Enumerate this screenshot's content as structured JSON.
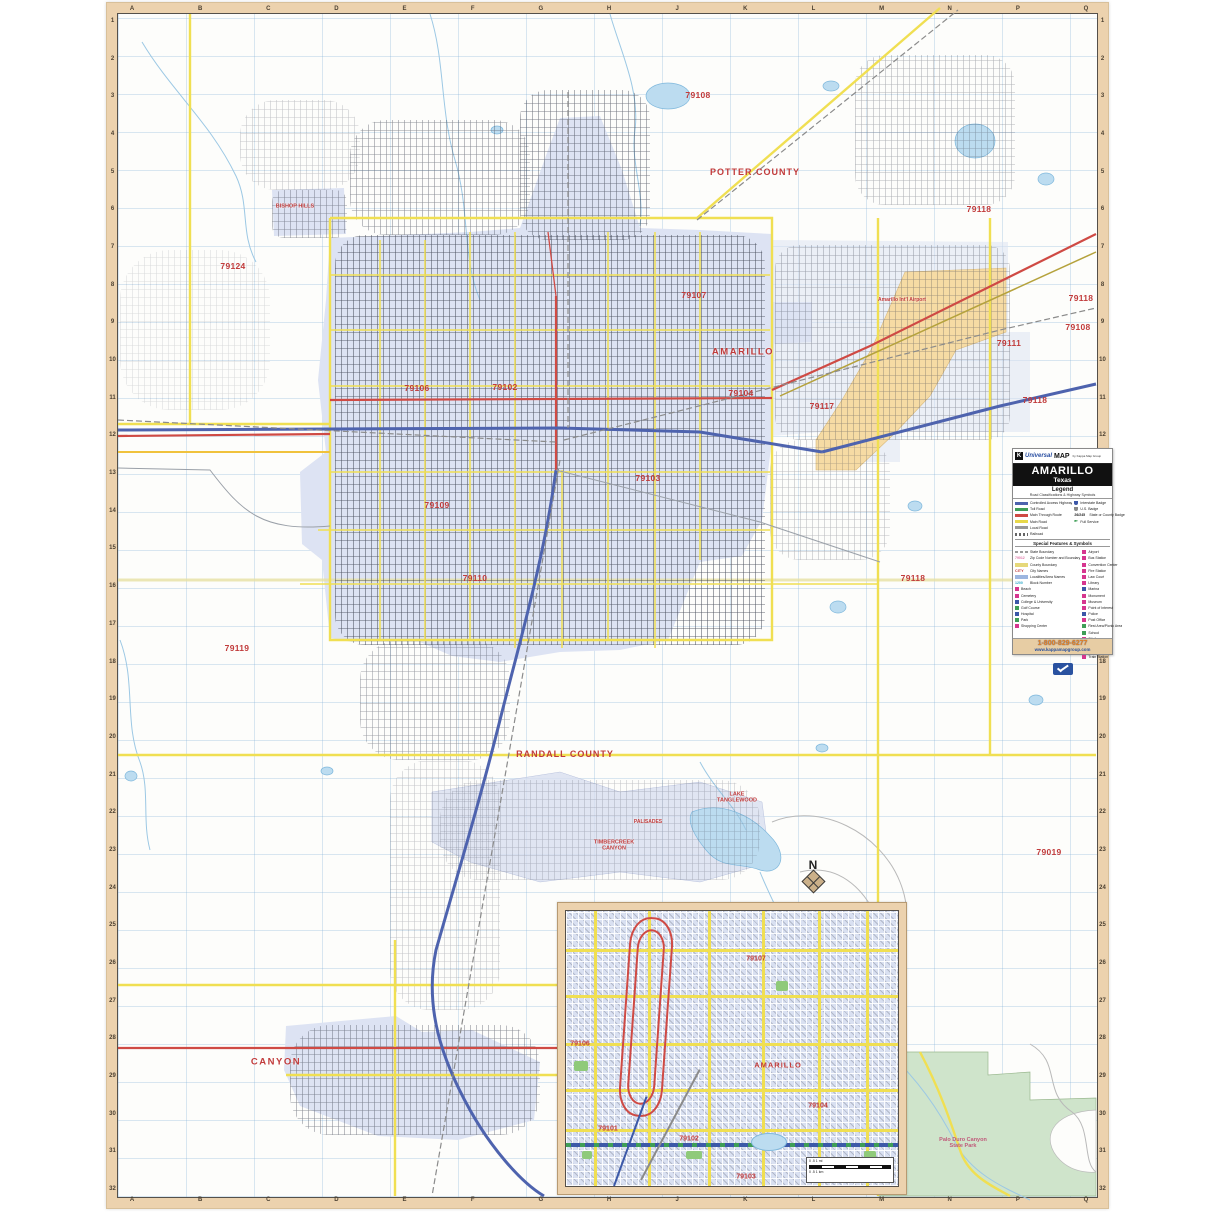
{
  "title_block": {
    "brand_k": "K",
    "brand_universal": "Universal",
    "brand_map": "MAP",
    "brand_by": "by Kappa Map Group",
    "title": "AMARILLO",
    "subtitle": "Texas",
    "legend_heading": "Legend",
    "legend_sub": "Road Classifications & Highway Symbols",
    "special_heading": "Special Features & Symbols",
    "footer": {
      "phone": "1-800-829-6277",
      "url": "www.kappamapgroup.com"
    }
  },
  "legend": {
    "road_classes": [
      {
        "label": "Controlled Access Highway",
        "kind": "line",
        "color": "#4e63ae"
      },
      {
        "label": "Toll Road",
        "kind": "line",
        "color": "#3f9e57"
      },
      {
        "label": "Main Through Route",
        "kind": "line",
        "color": "#cf4a44"
      },
      {
        "label": "Main Road",
        "kind": "line",
        "color": "#e8d84a"
      },
      {
        "label": "Local Road",
        "kind": "line",
        "color": "#999999"
      },
      {
        "label": "Railroad",
        "kind": "rail",
        "color": "#666666"
      }
    ],
    "badges": [
      {
        "label": "Interstate Badge",
        "kind": "shield",
        "color": "#3c57a8"
      },
      {
        "label": "U.S. Badge",
        "kind": "shield",
        "color": "#888888"
      },
      {
        "label": "State or County Badge",
        "kind": "text",
        "text": "26/245"
      },
      {
        "label": "Full Service",
        "kind": "flag",
        "color": "#3f9e57"
      }
    ],
    "special_left": [
      {
        "label": "State Boundary",
        "kind": "dash",
        "color": "#9a9a9a"
      },
      {
        "label": "Zip Code Number and Boundary",
        "kind": "zip",
        "color": "#e077a8"
      },
      {
        "label": "County Boundary",
        "kind": "band",
        "color": "#e6d87a"
      },
      {
        "label": "City Names",
        "kind": "citytext",
        "color": "#c13b3b"
      },
      {
        "label": "Localities/Area Names",
        "kind": "band",
        "color": "#9db6e0"
      },
      {
        "label": "Block Number",
        "kind": "block",
        "color": "#2aa7c9"
      },
      {
        "label": "Beach",
        "kind": "sq",
        "color": "#d6368f"
      },
      {
        "label": "Cemetery",
        "kind": "sq",
        "color": "#d6368f"
      },
      {
        "label": "College & University",
        "kind": "sq",
        "color": "#3c57a8"
      },
      {
        "label": "Golf Course",
        "kind": "sq",
        "color": "#3f9e57"
      },
      {
        "label": "Hospital",
        "kind": "sq",
        "color": "#3c57a8"
      },
      {
        "label": "Park",
        "kind": "sq",
        "color": "#3f9e57"
      },
      {
        "label": "Shopping Center",
        "kind": "sq",
        "color": "#d6368f"
      }
    ],
    "special_right": [
      {
        "label": "Airport",
        "kind": "sq",
        "color": "#d6368f"
      },
      {
        "label": "Bus Station",
        "kind": "sq",
        "color": "#d6368f"
      },
      {
        "label": "Convention Center",
        "kind": "sq",
        "color": "#d6368f"
      },
      {
        "label": "Fire Station",
        "kind": "sq",
        "color": "#d6368f"
      },
      {
        "label": "Law Court",
        "kind": "sq",
        "color": "#d6368f"
      },
      {
        "label": "Library",
        "kind": "sq",
        "color": "#d6368f"
      },
      {
        "label": "Marina",
        "kind": "sq",
        "color": "#3c57a8"
      },
      {
        "label": "Monument",
        "kind": "sq",
        "color": "#d6368f"
      },
      {
        "label": "Museum",
        "kind": "sq",
        "color": "#d6368f"
      },
      {
        "label": "Point of Interest",
        "kind": "sq",
        "color": "#d6368f"
      },
      {
        "label": "Police",
        "kind": "sq",
        "color": "#3c57a8"
      },
      {
        "label": "Post Office",
        "kind": "sq",
        "color": "#d6368f"
      },
      {
        "label": "Rest Area/Picnic Area",
        "kind": "sq",
        "color": "#3f9e57"
      },
      {
        "label": "School",
        "kind": "sq",
        "color": "#3f9e57"
      },
      {
        "label": "Ski Area",
        "kind": "sq",
        "color": "#d6368f"
      },
      {
        "label": "Theater",
        "kind": "sq",
        "color": "#d6368f"
      },
      {
        "label": "Town Hall",
        "kind": "sq",
        "color": "#d6368f"
      },
      {
        "label": "Train Station",
        "kind": "sq",
        "color": "#d6368f"
      }
    ]
  },
  "grid": {
    "letters": [
      "A",
      "B",
      "C",
      "D",
      "E",
      "F",
      "G",
      "H",
      "J",
      "K",
      "L",
      "M",
      "N",
      "P",
      "Q"
    ],
    "numbers_from": 1,
    "numbers_to": 32
  },
  "compass": {
    "n": "N"
  },
  "labels": [
    {
      "t": "79108",
      "x": 698,
      "y": 95,
      "cls": "zip"
    },
    {
      "t": "79118",
      "x": 979,
      "y": 209,
      "cls": "zip"
    },
    {
      "t": "79124",
      "x": 233,
      "y": 266,
      "cls": "zip"
    },
    {
      "t": "79107",
      "x": 694,
      "y": 295,
      "cls": "zip"
    },
    {
      "t": "79118",
      "x": 1081,
      "y": 298,
      "cls": "zip"
    },
    {
      "t": "79108",
      "x": 1078,
      "y": 327,
      "cls": "zip"
    },
    {
      "t": "79111",
      "x": 1009,
      "y": 343,
      "cls": "zip"
    },
    {
      "t": "79104",
      "x": 741,
      "y": 393,
      "cls": "zip"
    },
    {
      "t": "79118",
      "x": 1035,
      "y": 400,
      "cls": "zip"
    },
    {
      "t": "79117",
      "x": 822,
      "y": 406,
      "cls": "zip"
    },
    {
      "t": "79106",
      "x": 417,
      "y": 388,
      "cls": "zip"
    },
    {
      "t": "79102",
      "x": 505,
      "y": 387,
      "cls": "zip"
    },
    {
      "t": "79103",
      "x": 648,
      "y": 478,
      "cls": "zip"
    },
    {
      "t": "79109",
      "x": 437,
      "y": 505,
      "cls": "zip"
    },
    {
      "t": "79110",
      "x": 475,
      "y": 578,
      "cls": "zip"
    },
    {
      "t": "79118",
      "x": 913,
      "y": 578,
      "cls": "zip"
    },
    {
      "t": "79119",
      "x": 237,
      "y": 648,
      "cls": "zip"
    },
    {
      "t": "79019",
      "x": 1049,
      "y": 852,
      "cls": "zip"
    },
    {
      "t": "POTTER COUNTY",
      "x": 755,
      "y": 172,
      "cls": "countyl"
    },
    {
      "t": "RANDALL COUNTY",
      "x": 565,
      "y": 754,
      "cls": "countyl"
    },
    {
      "t": "AMARILLO",
      "x": 743,
      "y": 352,
      "cls": "city"
    },
    {
      "t": "BISHOP HILLS",
      "x": 295,
      "y": 207,
      "cls": "small2"
    },
    {
      "t": "CANYON",
      "x": 276,
      "y": 1062,
      "cls": "city"
    },
    {
      "t": "TIMBERCREEK CANYON",
      "x": 614,
      "y": 846,
      "cls": "small2"
    },
    {
      "t": "PALISADES",
      "x": 648,
      "y": 822,
      "cls": "small"
    },
    {
      "t": "LAKE TANGLEWOOD",
      "x": 737,
      "y": 798,
      "cls": "small2"
    },
    {
      "t": "Palo Duro Canyon State Park",
      "x": 963,
      "y": 1143,
      "cls": "parklb"
    },
    {
      "t": "Amarillo Int'l Airport",
      "x": 902,
      "y": 300,
      "cls": "small"
    }
  ],
  "geometry": {
    "fills": [
      {
        "c": "urban",
        "d": "M330,238 L470,232 L520,228 L548,150 L560,118 L600,116 L622,170 L640,228 L700,230 L772,234 L772,302 L812,302 L812,342 L774,344 L772,440 L762,520 L742,556 L700,562 L668,640 L620,650 L560,652 L500,662 L452,656 L420,642 L352,642 L330,638 L322,560 L302,544 L300,472 L326,452 L318,380 L326,300 Z"
      },
      {
        "c": "urban2",
        "d": "M772,240 L1008,242 L1008,332 L1030,332 L1030,432 L900,432 L900,462 L822,462 L822,432 L772,436 Z"
      },
      {
        "c": "urban",
        "d": "M286,1026 L396,1016 L422,1032 L472,1030 L540,1062 L534,1120 L458,1140 L378,1136 L300,1106 L284,1070 Z"
      },
      {
        "c": "urban3",
        "d": "M432,792 L560,772 L620,792 L700,782 L762,802 L770,862 L700,882 L620,872 L540,882 L470,862 L432,842 Z"
      },
      {
        "c": "urban",
        "d": "M272,190 L344,188 L346,234 L274,236 Z"
      },
      {
        "c": "airport",
        "d": "M905,272 L1006,268 L1006,332 L956,350 L930,396 L894,434 L856,470 L816,470 L816,440 L842,400 L872,348 Z"
      },
      {
        "c": "park",
        "d": "M878,1052 L988,1052 L988,1075 L1030,1072 L1030,1100 L1096,1098 L1096,1196 L878,1196 Z"
      },
      {
        "c": "canyonwhite",
        "d": "M1096,1110 C1050,1112 1040,1140 1060,1160 C1075,1175 1096,1172 1096,1172 Z"
      },
      {
        "c": "lake",
        "d": "M692,812 C722,800 752,816 770,836 C790,856 780,876 760,870 C740,862 722,870 706,850 C696,838 686,822 692,812 Z"
      }
    ],
    "lakes": [
      [
        668,
        96,
        22,
        13
      ],
      [
        975,
        141,
        20,
        17
      ],
      [
        1046,
        179,
        8,
        6
      ],
      [
        831,
        86,
        8,
        5
      ],
      [
        838,
        607,
        8,
        6
      ],
      [
        915,
        506,
        7,
        5
      ],
      [
        1062,
        621,
        8,
        6
      ],
      [
        822,
        748,
        6,
        4
      ],
      [
        327,
        771,
        6,
        4
      ],
      [
        131,
        776,
        6,
        5
      ],
      [
        1036,
        700,
        7,
        5
      ],
      [
        497,
        130,
        6,
        4
      ]
    ],
    "paths": [
      {
        "c": "river",
        "d": "M430,14 C445,60 440,110 455,160 C470,210 462,258 480,300"
      },
      {
        "c": "river",
        "d": "M610,14 C620,50 640,90 635,130 C630,162 645,192 640,226"
      },
      {
        "c": "river",
        "d": "M142,42 C172,92 210,122 236,176 C250,206 240,232 256,262"
      },
      {
        "c": "river",
        "d": "M890,1054 C920,1082 940,1112 955,1142 C970,1172 1000,1186 1030,1200"
      },
      {
        "c": "river",
        "d": "M700,762 C715,790 735,806 746,830"
      },
      {
        "c": "river",
        "d": "M760,872 C772,902 790,932 800,966 C810,1000 830,1022 858,1046"
      },
      {
        "c": "river",
        "d": "M120,640 C136,682 124,722 140,762 C150,790 142,820 150,850"
      },
      {
        "c": "contour",
        "d": "M772,822 C820,802 880,832 900,882 C920,932 890,962 862,942"
      },
      {
        "c": "contour",
        "d": "M800,872 C840,862 870,892 882,932"
      },
      {
        "c": "contour",
        "d": "M1030,1044 C1062,1062 1042,1092 1072,1112 C1092,1127 1082,1162 1096,1172"
      },
      {
        "c": "county",
        "d": "M118,580 L1096,580"
      },
      {
        "c": "yroad",
        "d": "M330,218 L330,640 L772,640 L772,218 L330,218"
      },
      {
        "c": "yroad",
        "d": "M697,218 L940,8"
      },
      {
        "c": "yroad",
        "d": "M878,218 L878,1196"
      },
      {
        "c": "yroad",
        "d": "M118,755 L1096,755"
      },
      {
        "c": "yroad",
        "d": "M190,14 L190,424"
      },
      {
        "c": "yroad",
        "d": "M118,424 L330,424"
      },
      {
        "c": "yroad",
        "d": "M395,940 L395,1196"
      },
      {
        "c": "yroad",
        "d": "M286,1075 L560,1075"
      },
      {
        "c": "yroad",
        "d": "M990,218 L990,755"
      },
      {
        "c": "yroad",
        "d": "M118,985 L878,985"
      },
      {
        "c": "yroad",
        "d": "M920,1052 C940,1090 950,1120 960,1150 C968,1175 990,1185 1010,1196"
      },
      {
        "c": "oroad",
        "d": "M118,452 L330,452"
      },
      {
        "c": "olive",
        "d": "M780,396 L1096,252"
      },
      {
        "c": "ycity",
        "d": "M380,240 L380,640 M425,240 L425,640 M470,232 L470,640 M515,232 L515,648 M562,470 L562,648 M608,232 L608,640 M655,232 L655,648 M700,232 L700,560"
      },
      {
        "c": "ycity",
        "d": "M330,275 L770,275 M330,330 L770,330 M330,386 L770,386 M330,472 L770,472 M318,530 L770,530 M300,584 L878,584"
      },
      {
        "c": "rroad",
        "d": "M772,390 L870,346 L1096,234"
      },
      {
        "c": "rroad",
        "d": "M330,400 L772,398"
      },
      {
        "c": "rroad",
        "d": "M118,1048 L560,1048"
      },
      {
        "c": "rroad",
        "d": "M118,436 L330,434"
      },
      {
        "c": "rroad",
        "d": "M556,296 L556,470"
      },
      {
        "c": "rthin",
        "d": "M556,296 L548,232"
      },
      {
        "c": "iroad",
        "d": "M118,430 L560,428 L700,432 L822,452"
      },
      {
        "c": "iroad",
        "d": "M822,452 L1000,406 L1096,384"
      },
      {
        "c": "iroad",
        "d": "M556,470 C544,560 520,640 500,720 C480,800 456,880 436,950 C424,1008 442,1060 470,1110 C490,1146 520,1182 544,1196"
      },
      {
        "c": "rail",
        "d": "M568,92 L568,428"
      },
      {
        "c": "rail",
        "d": "M564,440 L1000,330 L1096,308"
      },
      {
        "c": "rail",
        "d": "M560,460 L432,1196"
      },
      {
        "c": "rail",
        "d": "M118,420 L556,442"
      },
      {
        "c": "rail",
        "d": "M697,220 L958,10"
      },
      {
        "c": "lroad",
        "d": "M118,468 L210,470 C242,512 262,532 330,526"
      },
      {
        "c": "lroad",
        "d": "M556,470 L760,522 L880,562"
      }
    ]
  },
  "textures": [
    {
      "x": 335,
      "y": 235,
      "w": 430,
      "h": 410,
      "r": "30px",
      "o": 0.85
    },
    {
      "x": 350,
      "y": 120,
      "w": 180,
      "h": 115,
      "r": "36px",
      "o": 0.6
    },
    {
      "x": 520,
      "y": 90,
      "w": 130,
      "h": 150,
      "r": "28px",
      "o": 0.7
    },
    {
      "x": 775,
      "y": 245,
      "w": 235,
      "h": 195,
      "r": "24px",
      "o": 0.45
    },
    {
      "x": 360,
      "y": 640,
      "w": 150,
      "h": 120,
      "r": "40px",
      "o": 0.5
    },
    {
      "x": 390,
      "y": 760,
      "w": 110,
      "h": 250,
      "r": "40px",
      "o": 0.3
    },
    {
      "x": 290,
      "y": 1025,
      "w": 250,
      "h": 110,
      "r": "40px",
      "o": 0.6
    },
    {
      "x": 272,
      "y": 190,
      "w": 75,
      "h": 48,
      "r": "12px",
      "o": 0.55
    },
    {
      "x": 855,
      "y": 55,
      "w": 160,
      "h": 150,
      "r": "30px",
      "o": 0.4
    },
    {
      "x": 240,
      "y": 100,
      "w": 120,
      "h": 90,
      "r": "36px",
      "o": 0.3
    },
    {
      "x": 440,
      "y": 780,
      "w": 320,
      "h": 100,
      "r": "40px",
      "o": 0.3
    },
    {
      "x": 120,
      "y": 250,
      "w": 150,
      "h": 160,
      "r": "50px",
      "o": 0.18
    },
    {
      "x": 770,
      "y": 440,
      "w": 120,
      "h": 120,
      "r": "30px",
      "o": 0.35
    }
  ],
  "inset": {
    "labels": [
      {
        "t": "79107",
        "x": 190,
        "y": 48,
        "cls": "zipS"
      },
      {
        "t": "79106",
        "x": 14,
        "y": 133,
        "cls": "zipS"
      },
      {
        "t": "AMARILLO",
        "x": 212,
        "y": 154,
        "cls": "cityS"
      },
      {
        "t": "79104",
        "x": 252,
        "y": 195,
        "cls": "zipS"
      },
      {
        "t": "79101",
        "x": 42,
        "y": 218,
        "cls": "zipS"
      },
      {
        "t": "79102",
        "x": 123,
        "y": 228,
        "cls": "zipS"
      },
      {
        "t": "79103",
        "x": 180,
        "y": 266,
        "cls": "zipS"
      }
    ],
    "yellow_vx": [
      28,
      82,
      142,
      196,
      252,
      300
    ],
    "yellow_hy": [
      38,
      84,
      132,
      178,
      218
    ],
    "loop_outer": {
      "x": 58,
      "y": 6,
      "w": 40,
      "h": 196
    },
    "loop_inner": {
      "x": 66,
      "y": 18,
      "w": 24,
      "h": 172
    },
    "i40_y": 232,
    "diagonals": [
      {
        "x": 75,
        "y": 268,
        "len": 125,
        "rot": -62,
        "color": "#8b8b8b"
      },
      {
        "x": 48,
        "y": 274,
        "len": 95,
        "rot": -70,
        "color": "#3c59a8"
      }
    ],
    "parks": [
      {
        "x": 8,
        "y": 150,
        "w": 14,
        "h": 10
      },
      {
        "x": 120,
        "y": 240,
        "w": 16,
        "h": 8
      },
      {
        "x": 210,
        "y": 70,
        "w": 12,
        "h": 10
      },
      {
        "x": 16,
        "y": 240,
        "w": 10,
        "h": 8
      },
      {
        "x": 298,
        "y": 240,
        "w": 12,
        "h": 8
      }
    ],
    "ponds": [
      {
        "x": 185,
        "y": 222,
        "w": 34,
        "h": 16
      }
    ],
    "scale": {
      "x": 240,
      "y": 246,
      "w": 82,
      "h": 22,
      "top": "0      .5      1 mi",
      "bot": "0   .5   1 km"
    }
  }
}
